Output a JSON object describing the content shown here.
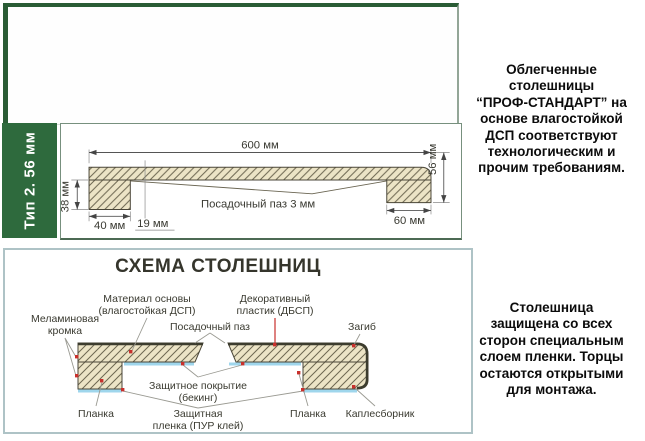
{
  "type_label": "Тип 2. 56 мм",
  "profile": {
    "dim_width": "600 мм",
    "dim_total_height": "56 мм",
    "dim_edge_height": "38 мм",
    "dim_left_block": "40 мм",
    "dim_offset": "19 мм",
    "dim_right_block": "60 мм",
    "groove_note": "Посадочный паз 3 мм"
  },
  "scheme": {
    "title": "СХЕМА СТОЛЕШНИЦ",
    "labels": {
      "melamine_line1": "Меламиновая",
      "melamine_line2": "кромка",
      "base_line1": "Материал основы",
      "base_line2": "(влагостойкая ДСП)",
      "groove": "Посадочный паз",
      "decor_line1": "Декоративный",
      "decor_line2": "пластик (ДБСП)",
      "bend": "Загиб",
      "backing_line1": "Защитное покрытие",
      "backing_line2": "(бекинг)",
      "strip_left": "Планка",
      "film_line1": "Защитная",
      "film_line2": "пленка (ПУР клей)",
      "strip_right": "Планка",
      "drip_edge": "Каплесборник"
    }
  },
  "descriptions": {
    "top_lines": [
      "Облегченные",
      "столешницы",
      "“ПРОФ-СТАНДАРТ” на",
      "основе влагостойкой",
      "ДСП соответствуют",
      "технологическим и",
      "прочим требованиям."
    ],
    "bottom_lines": [
      "Столешница",
      "защищена со всех",
      "сторон специальным",
      "слоем пленки. Торцы",
      "остаются открытыми",
      "для монтажа."
    ]
  },
  "colors": {
    "brand_green": "#2e6a3d",
    "hatch_fill": "#ece4c6",
    "film_blue": "#9fd6ec",
    "marker_red": "#c8302c"
  }
}
